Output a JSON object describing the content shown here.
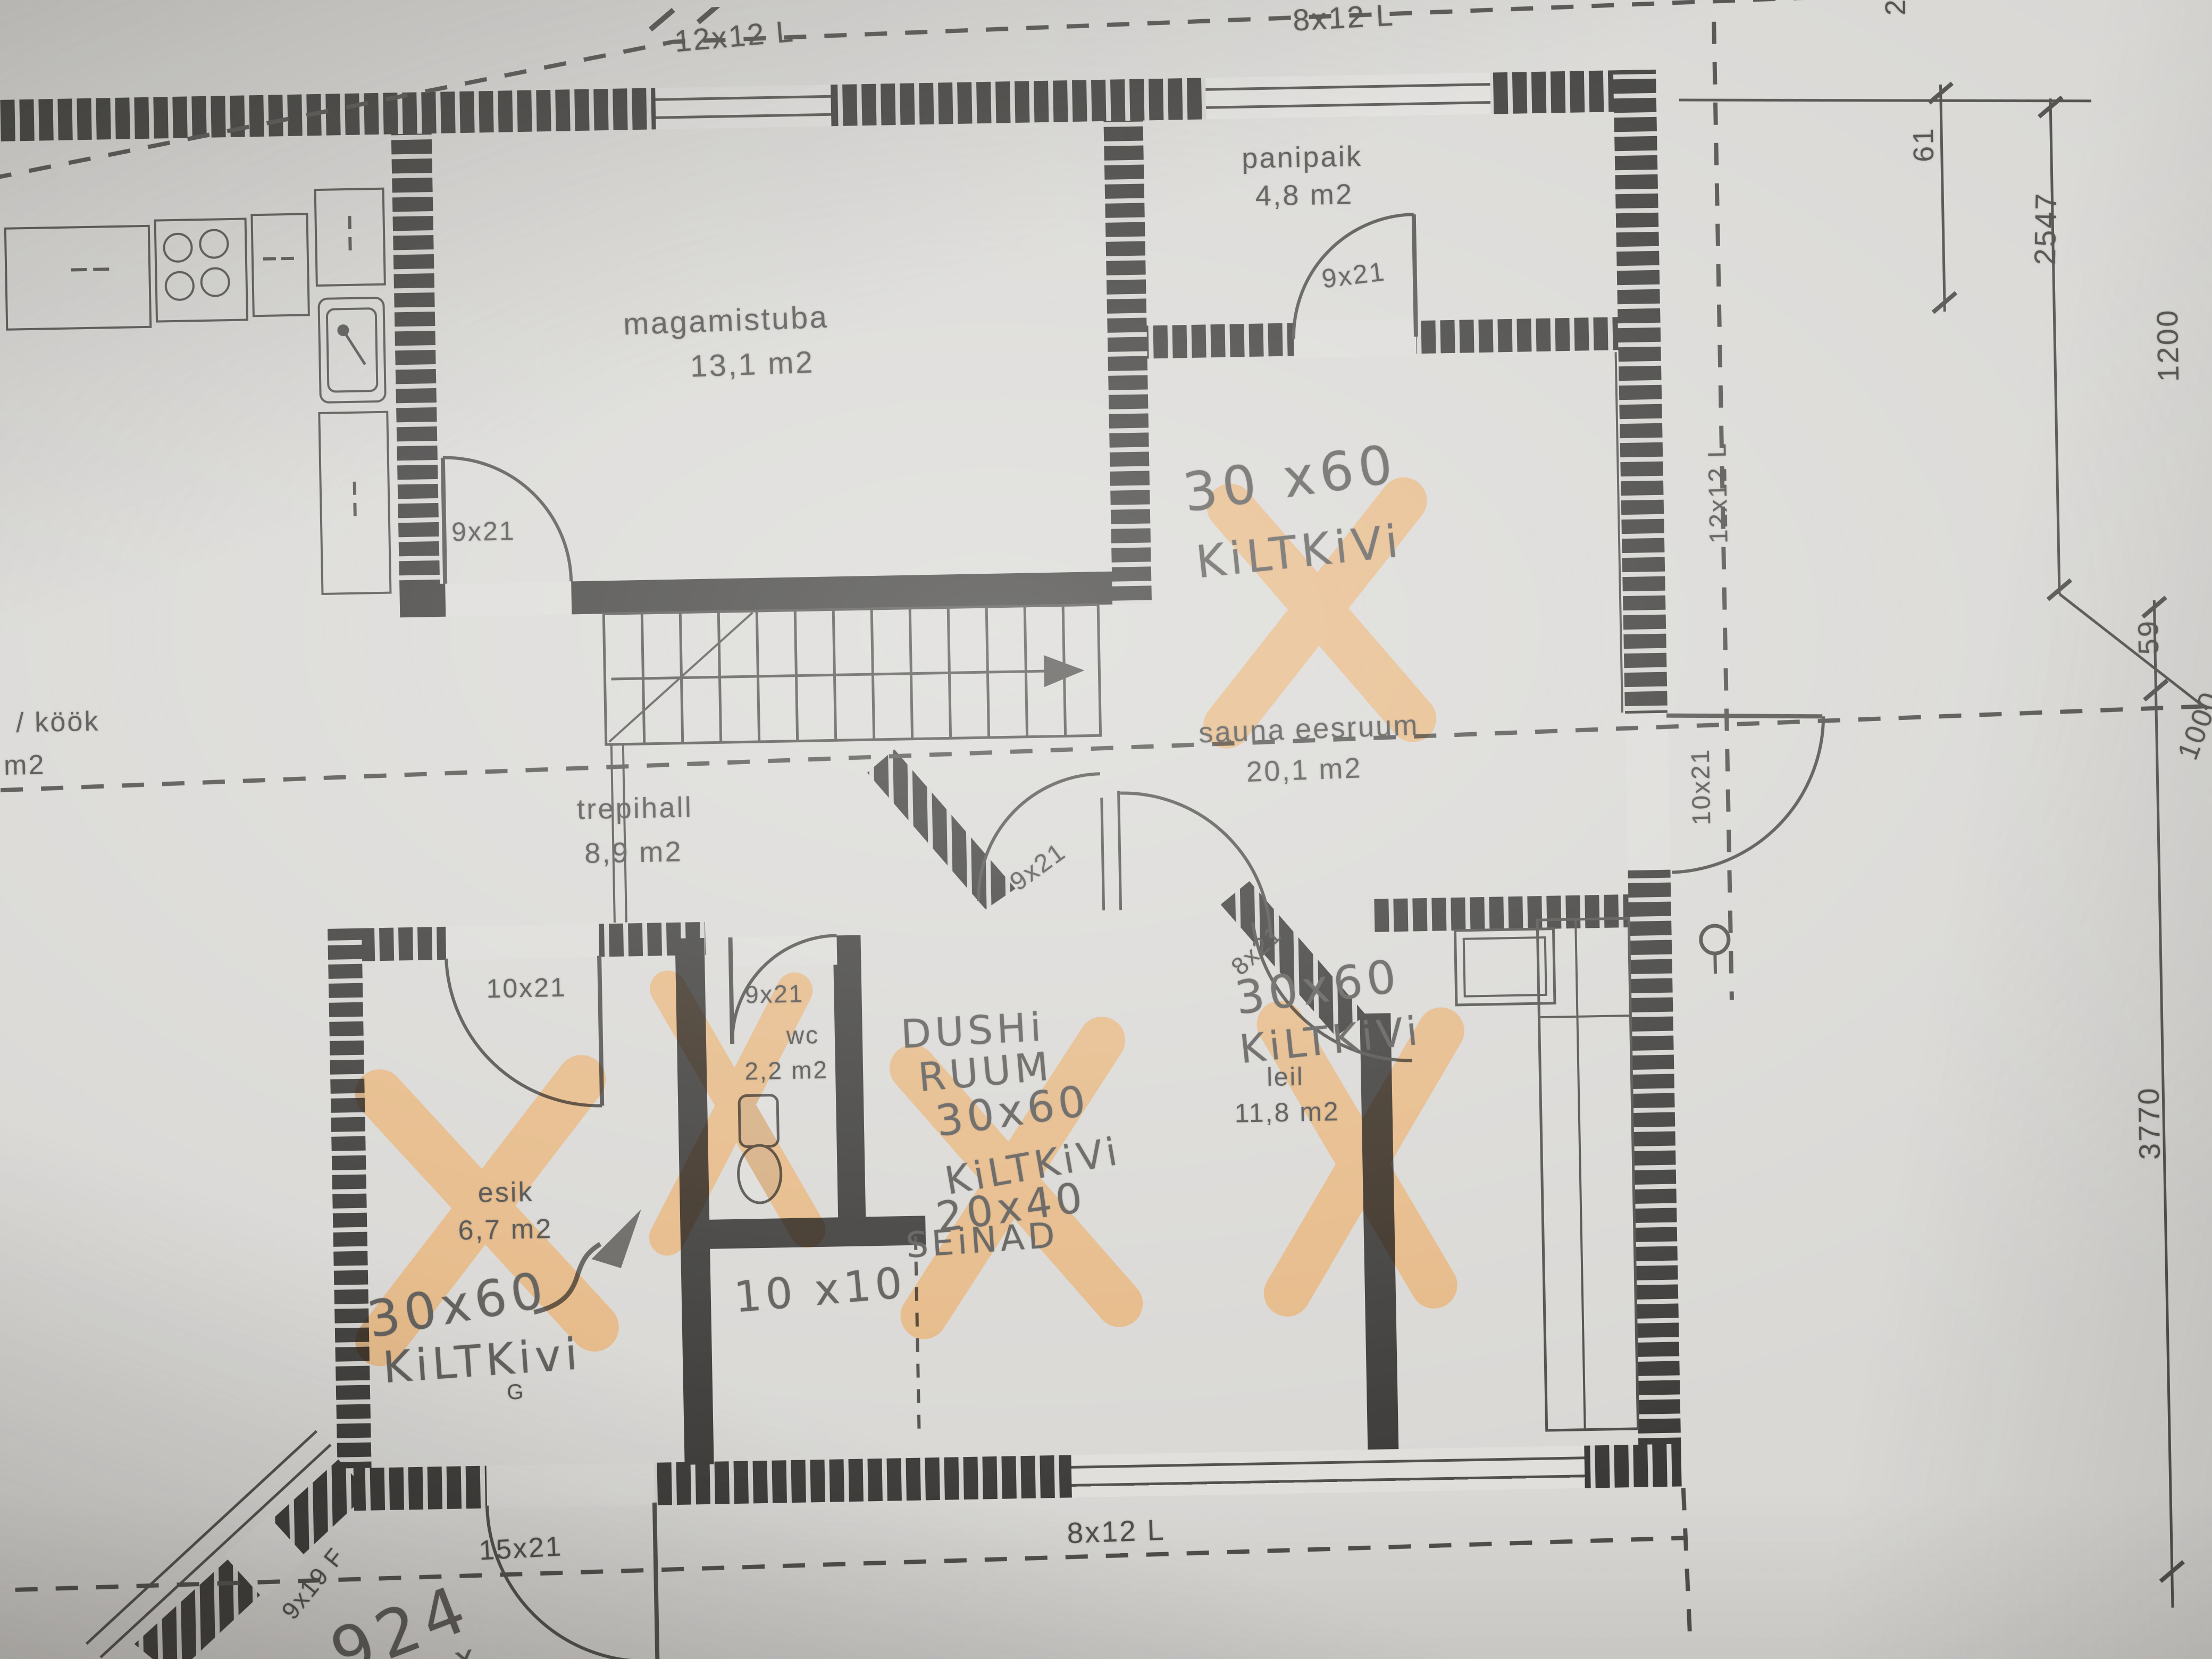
{
  "colors": {
    "paper": "#d9d8d5",
    "ink": "#4e4c49",
    "pencil": "#5c5a57",
    "wall": "#3b3a38",
    "highlight": "#f0a14b"
  },
  "windows": {
    "top_left": "12x12 L",
    "top_right": "8x12 L",
    "bottom": "8x12 L",
    "right": "12x12 L"
  },
  "rooms": {
    "kook": {
      "name": "/ köök",
      "area": "m2"
    },
    "magamistuba": {
      "name": "magamistuba",
      "area": "13,1 m2"
    },
    "panipaik": {
      "name": "panipaik",
      "area": "4,8 m2"
    },
    "sauna_eesruum": {
      "name": "sauna eesruum",
      "area": "20,1 m2"
    },
    "trepihall": {
      "name": "trepihall",
      "area": "8,9 m2"
    },
    "wc": {
      "name": "wc",
      "area": "2,2 m2"
    },
    "esik": {
      "name": "esik",
      "area": "6,7 m2"
    },
    "leil": {
      "name": "leil",
      "area": "11,8 m2"
    }
  },
  "doors": {
    "magamistuba": "9x21",
    "panipaik": "9x21",
    "trepihall": "9x21",
    "wc": "9x21",
    "esik": "10x21",
    "leil": "8x21",
    "eesruum_exterior": "10x21",
    "entry": "15x21",
    "terrace": "9x19 F"
  },
  "dimensions": {
    "a": "61",
    "b": "2547",
    "c": "1200",
    "d": "59",
    "e": "1000",
    "f": "3770",
    "g": "2"
  },
  "handwritten": {
    "eesruum_tiles_line1": "30 x60",
    "eesruum_tiles_line2": "KiLTKiVi",
    "dush_name_line1": "DUSHi",
    "dush_name_line2": "RUUM",
    "dush_tiles_line1": "30x60",
    "dush_tiles_line2": "KiLTKiVi",
    "dush_walls_line1": "20x40",
    "dush_walls_line2": "SEiNAD",
    "leil_tiles_line1": "30x60",
    "leil_tiles_line2": "KiLTKiVi",
    "esik_tiles_line1": "30x60",
    "esik_tiles_line2": "KiLTKivi",
    "floor_note": "10 x10",
    "corner_number": "924",
    "corner_mark": "x"
  },
  "marks": {
    "g": "G"
  }
}
